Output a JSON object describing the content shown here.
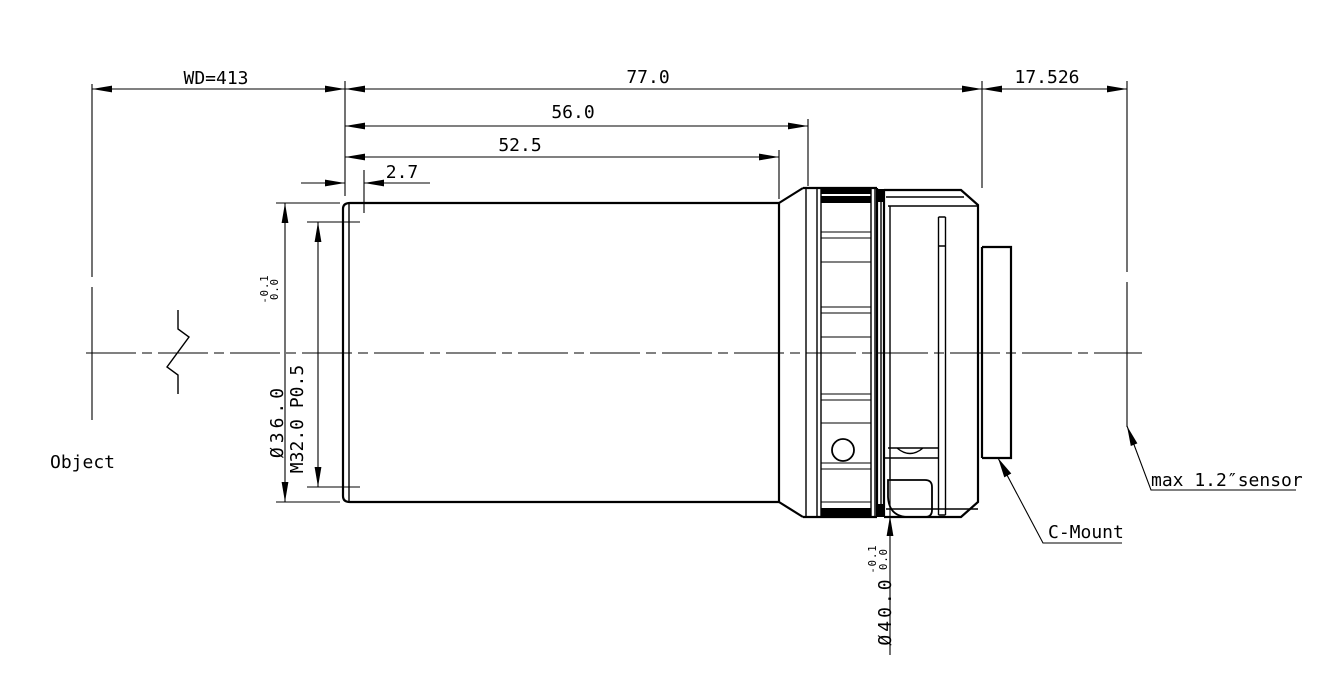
{
  "drawing": {
    "colors": {
      "line": "#000000",
      "background": "#ffffff"
    },
    "dimensions": {
      "working_distance": "WD=413",
      "total_length": "77.0",
      "flange_distance": "17.526",
      "barrel_length": "56.0",
      "front_section_length": "52.5",
      "front_step_length": "2.7",
      "front_diameter": "Ø36.0",
      "front_diameter_tol_upper": "0.0",
      "front_diameter_tol_lower": "-0.1",
      "front_thread": "M32.0 P0.5",
      "body_diameter": "Ø40.0",
      "body_diameter_tol_upper": "0.0",
      "body_diameter_tol_lower": "-0.1"
    },
    "labels": {
      "object_plane": "Object",
      "mount": "C-Mount",
      "sensor": "max 1.2″sensor"
    }
  }
}
